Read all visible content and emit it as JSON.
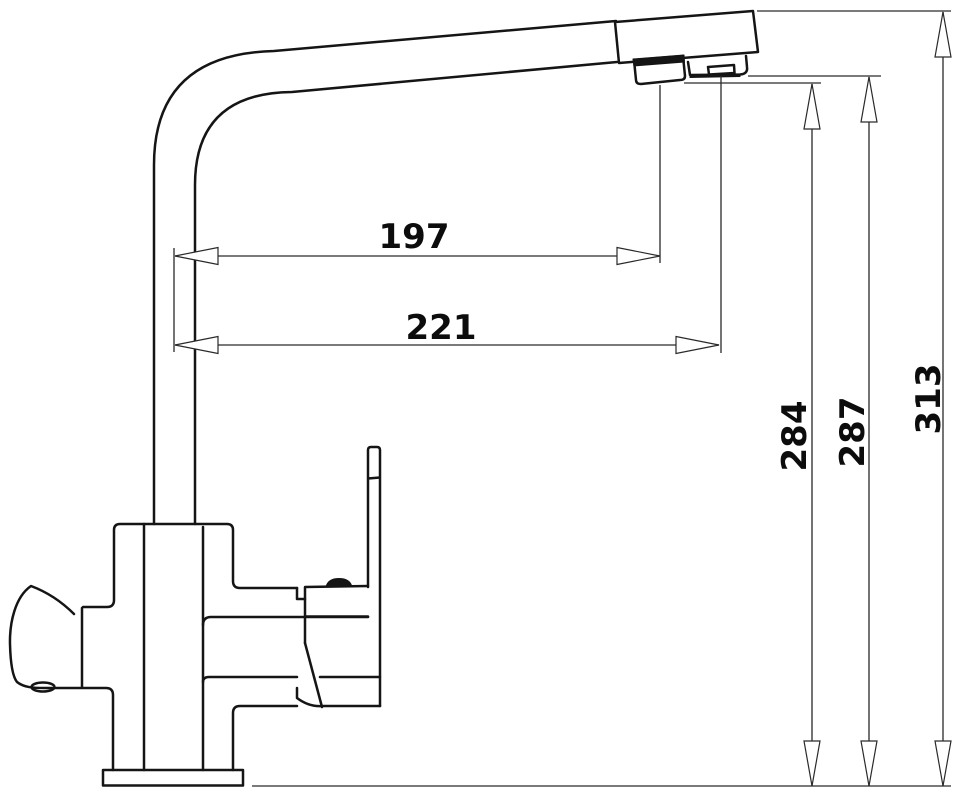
{
  "diagram": {
    "kind": "technical-dimension-drawing",
    "subject": "kitchen-faucet-side-view"
  },
  "colors": {
    "background": "#ffffff",
    "line": "#151515",
    "dimension_line": "#2a2a2a",
    "label": "#0c0c0c"
  },
  "dimensions": {
    "spout_reach_aerator": {
      "label": "197"
    },
    "spout_reach_tip": {
      "label": "221"
    },
    "height_aerator": {
      "label": "284"
    },
    "height_outlet": {
      "label": "287"
    },
    "height_overall": {
      "label": "313"
    }
  }
}
